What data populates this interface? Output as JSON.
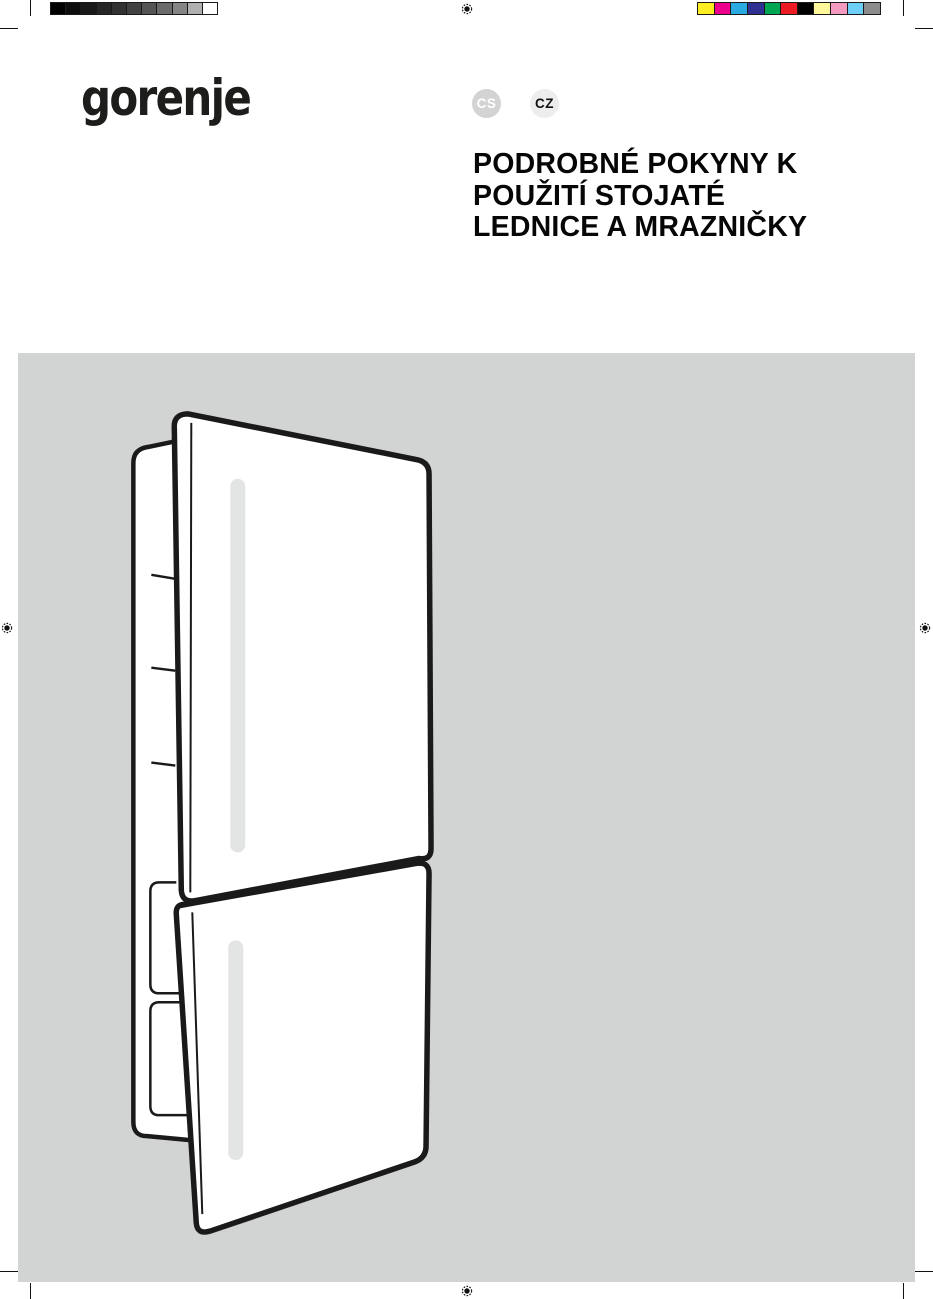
{
  "page": {
    "background": "#ffffff",
    "width": 933,
    "height": 1299
  },
  "print_marks": {
    "grayscale_bar": {
      "colors": [
        "#000000",
        "#0d0d0d",
        "#191919",
        "#262626",
        "#323232",
        "#424242",
        "#555555",
        "#6b6b6b",
        "#858585",
        "#b0b0b0",
        "#ffffff"
      ]
    },
    "color_bar": {
      "colors": [
        "#fcee21",
        "#ec008c",
        "#29abe2",
        "#2e3192",
        "#00a651",
        "#ed1c24",
        "#000000",
        "#fff799",
        "#f49ac1",
        "#6dcff6",
        "#8c8c8c"
      ]
    },
    "registration_mark_color": "#111111"
  },
  "header": {
    "logo_text": "gorenje",
    "logo_color": "#1d1d1b",
    "language_badges": [
      {
        "label": "CS",
        "bg": "#d3d3d3",
        "fg": "#ffffff"
      },
      {
        "label": "CZ",
        "bg": "#ededed",
        "fg": "#111111"
      }
    ],
    "title_lines": [
      "PODROBNÉ POKYNY K",
      "POUŽITÍ STOJATÉ",
      "LEDNICE A MRAZNIČKY"
    ],
    "title_full": "PODROBNÉ POKYNY K POUŽITÍ STOJATÉ LEDNICE A MRAZNIČKY"
  },
  "hero": {
    "background": "#d2d3d3",
    "illustration": "fridge-freezer-line-drawing",
    "illustration_alt": "Stojatá lednice a mraznička",
    "line_color": "#1a1a1a",
    "handle_color": "#e3e4e4"
  }
}
